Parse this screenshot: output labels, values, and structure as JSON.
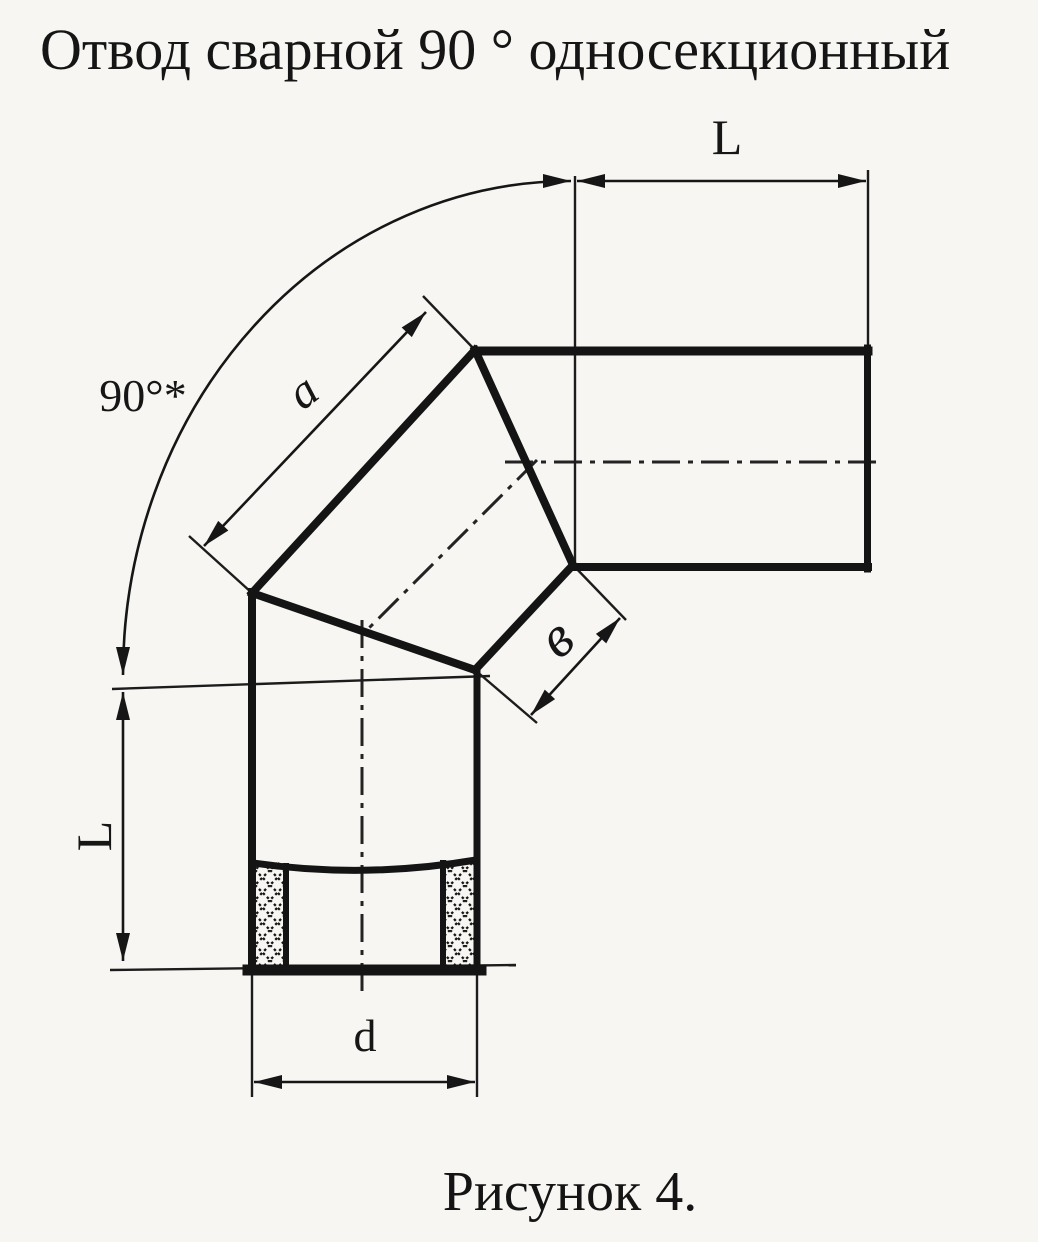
{
  "page": {
    "title": "Отвод сварной 90 ° односекционный",
    "caption": "Рисунок 4."
  },
  "drawing": {
    "description": "welded 90-degree single-section pipe elbow, dimensioned technical drawing",
    "ink_color": "#161616",
    "paper_color": "#f7f6f3",
    "labels": {
      "angle": "90°*",
      "length_top": "L",
      "length_left": "L",
      "section_edge": "a",
      "section_width": "в",
      "diameter": "d"
    }
  }
}
